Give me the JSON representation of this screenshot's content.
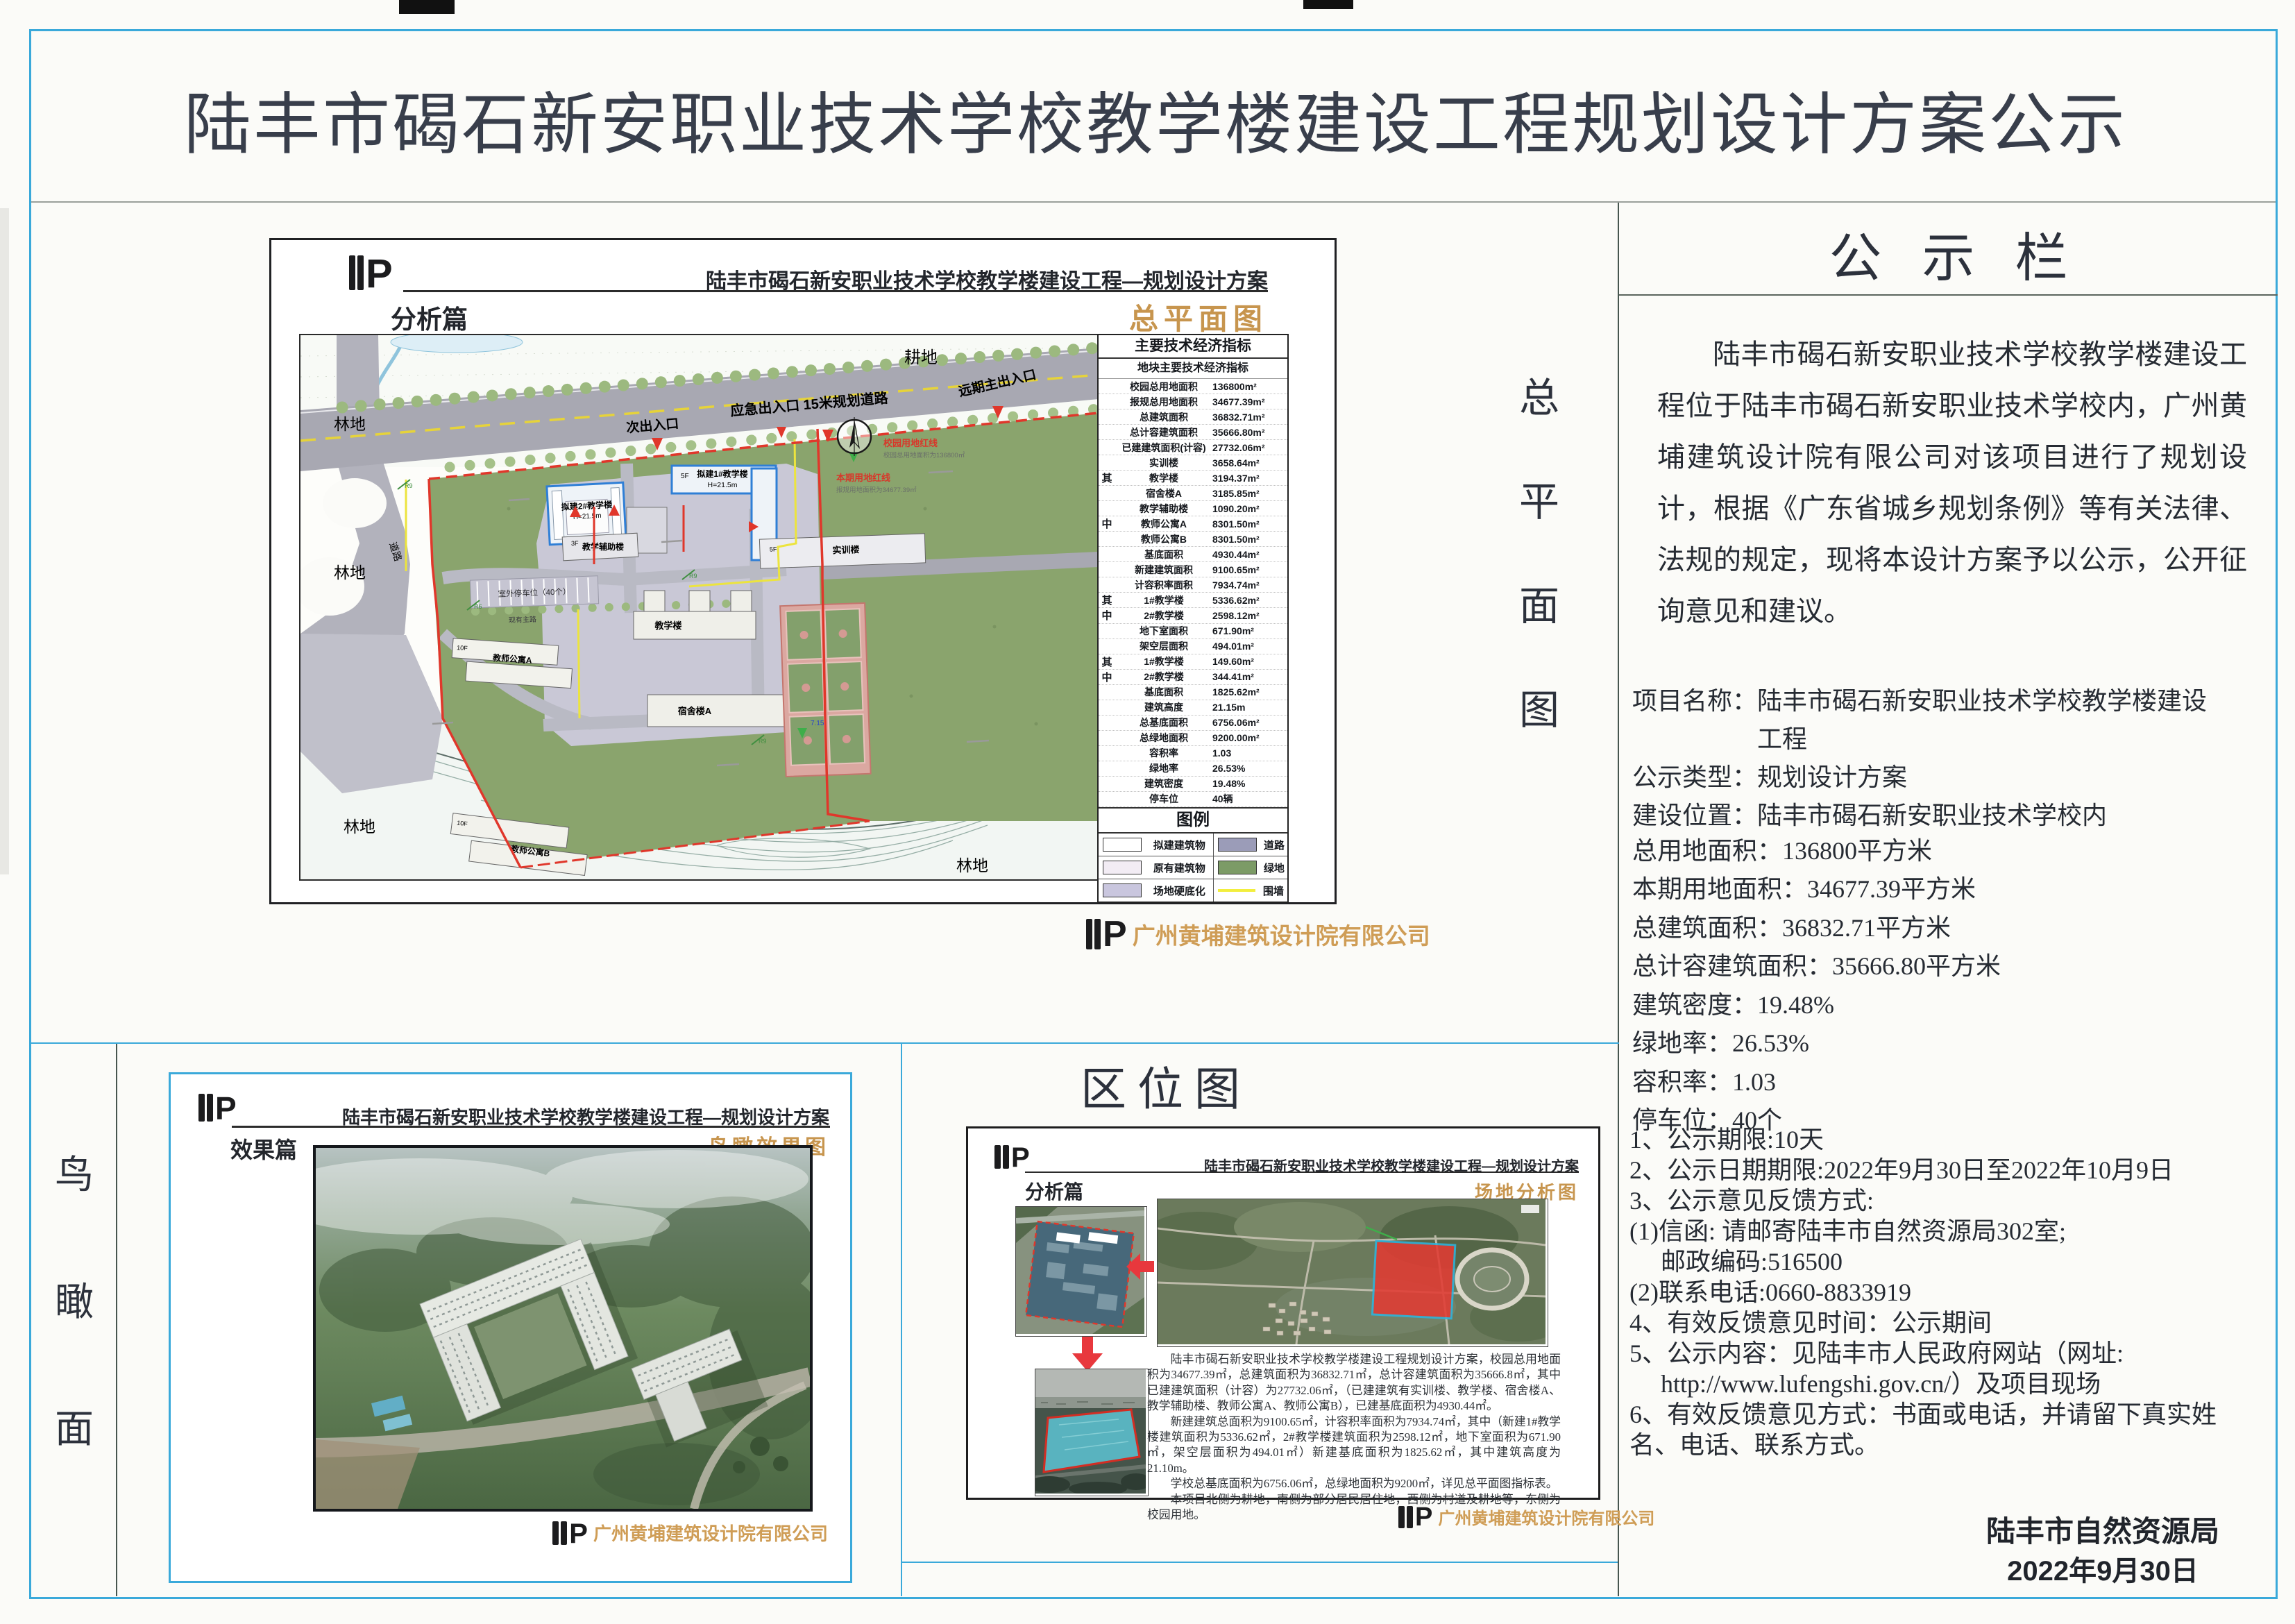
{
  "title": "陆丰市碣石新安职业技术学校教学楼建设工程规划设计方案公示",
  "common": {
    "project_header": "陆丰市碣石新安职业技术学校教学楼建设工程—规划设计方案",
    "company": "广州黄埔建筑设计院有限公司",
    "logo_letter": "P"
  },
  "vertical_labels": {
    "master_plan": [
      "总",
      "平",
      "面",
      "图"
    ],
    "aerial_view": [
      "鸟",
      "瞰",
      "面"
    ]
  },
  "site_plan": {
    "section": "分析篇",
    "sheet": "总平面图",
    "plan_labels": {
      "farmland": "耕地",
      "forest": "林地",
      "road_vertical": "道路",
      "planned_road": "应急出入口 15米规划道路",
      "secondary_entrance": "次出入口",
      "future_main_entrance": "远期主出入口",
      "new_building_1": "拟建1#教学楼",
      "new_building_2": "拟建2#教学楼",
      "building_height": "H=21.5m",
      "aux_building": "教学辅助楼",
      "training_building": "实训楼",
      "teaching_building": "教学楼",
      "dorm_a": "宿舍楼A",
      "teacher_apt_a": "教师公寓A",
      "teacher_apt_b": "教师公寓B",
      "parking": "室外停车位（40个）",
      "existing_road": "现有主路",
      "campus_red_line": "校园用地红线",
      "campus_red_line_sub": "校园总用地面积为136800㎡",
      "current_red_line": "本期用地红线",
      "current_red_line_sub": "报规用地面积为34677.39㎡",
      "level_mark": "7.15",
      "floors_3f": "3F",
      "floors_5f": "5F",
      "floors_10f": "10F",
      "r9": "R9",
      "r6": "R6"
    },
    "indicators": {
      "title": "主要技术经济指标",
      "subtitle": "地块主要技术经济指标",
      "rows": [
        [
          "",
          "校园总用地面积",
          "136800m²"
        ],
        [
          "",
          "报规总用地面积",
          "34677.39m²"
        ],
        [
          "",
          "总建筑面积",
          "36832.71m²"
        ],
        [
          "",
          "总计容建筑面积",
          "35666.80m²"
        ],
        [
          "",
          "已建建筑面积(计容)",
          "27732.06m²"
        ],
        [
          "",
          "实训楼",
          "3658.64m²"
        ],
        [
          "其",
          "教学楼",
          "3194.37m²"
        ],
        [
          "",
          "宿舍楼A",
          "3185.85m²"
        ],
        [
          "",
          "教学辅助楼",
          "1090.20m²"
        ],
        [
          "中",
          "教师公寓A",
          "8301.50m²"
        ],
        [
          "",
          "教师公寓B",
          "8301.50m²"
        ],
        [
          "",
          "基底面积",
          "4930.44m²"
        ],
        [
          "",
          "新建建筑面积",
          "9100.65m²"
        ],
        [
          "",
          "计容积率面积",
          "7934.74m²"
        ],
        [
          "其",
          "1#教学楼",
          "5336.62m²"
        ],
        [
          "中",
          "2#教学楼",
          "2598.12m²"
        ],
        [
          "",
          "地下室面积",
          "671.90m²"
        ],
        [
          "",
          "架空层面积",
          "494.01m²"
        ],
        [
          "其",
          "1#教学楼",
          "149.60m²"
        ],
        [
          "中",
          "2#教学楼",
          "344.41m²"
        ],
        [
          "",
          "基底面积",
          "1825.62m²"
        ],
        [
          "",
          "建筑高度",
          "21.15m"
        ],
        [
          "",
          "总基底面积",
          "6756.06m²"
        ],
        [
          "",
          "总绿地面积",
          "9200.00m²"
        ],
        [
          "",
          "容积率",
          "1.03"
        ],
        [
          "",
          "绿地率",
          "26.53%"
        ],
        [
          "",
          "建筑密度",
          "19.48%"
        ],
        [
          "",
          "停车位",
          "40辆"
        ]
      ],
      "legend": {
        "title": "图例",
        "row1": {
          "c1": "#ffffff",
          "l1": "拟建建筑物",
          "c2": "#9b9cb8",
          "l2": "道路"
        },
        "row2": {
          "c1": "#f2ecf4",
          "l1": "原有建筑物",
          "c2": "#7c9b66",
          "l2": "绿地"
        },
        "row3": {
          "c1": "#c9c6de",
          "l1": "场地硬底化",
          "c2": "#f2ee3e",
          "l2": "围墙"
        }
      }
    }
  },
  "aerial": {
    "section": "效果篇",
    "sheet": "鸟瞰效果图"
  },
  "location": {
    "title": "区位图",
    "section": "分析篇",
    "sheet": "场地分析图",
    "paragraphs": [
      "陆丰市碣石新安职业技术学校教学楼建设工程规划设计方案，校园总用地面积为34677.39㎡，总建筑面积为36832.71㎡，总计容建筑面积为35666.8㎡，其中已建建筑面积（计容）为27732.06㎡，（已建建筑有实训楼、教学楼、宿舍楼A、教学辅助楼、教师公寓A、教师公寓B），已建基底面积为4930.44㎡。",
      "新建建筑总面积为9100.65㎡，计容积率面积为7934.74㎡，其中（新建1#教学楼建筑面积为5336.62㎡，2#教学楼建筑面积为2598.12㎡，地下室面积为671.90㎡，架空层面积为494.01㎡）新建基底面积为1825.62㎡，其中建筑高度为21.10m。",
      "学校总基底面积为6756.06㎡，总绿地面积为9200㎡，详见总平面图指标表。",
      "本项目北侧为耕地，南侧为部分居民居住地，西侧为村道及耕地等，东侧为校园用地。"
    ]
  },
  "announcement": {
    "title": "公示栏",
    "intro": "陆丰市碣石新安职业技术学校教学楼建设工程位于陆丰市碣石新安职业技术学校内，广州黄埔建筑设计院有限公司对该项目进行了规划设计，根据《广东省城乡规划条例》等有关法律、法规的规定，现将本设计方案予以公示，公开征询意见和建议。",
    "fields": [
      "项目名称：陆丰市碣石新安职业技术学校教学楼建设",
      "　　　　　工程",
      "公示类型：规划设计方案",
      "建设位置：陆丰市碣石新安职业技术学校内"
    ],
    "metrics": [
      "总用地面积：136800平方米",
      "本期用地面积：34677.39平方米",
      "总建筑面积：36832.71平方米",
      "总计容建筑面积：35666.80平方米",
      "建筑密度：19.48%",
      "绿地率：26.53%",
      "容积率：1.03",
      "停车位：40个"
    ],
    "notes": [
      "1、公示期限:10天",
      "2、公示日期期限:2022年9月30日至2022年10月9日",
      "3、公示意见反馈方式:",
      "(1)信函: 请邮寄陆丰市自然资源局302室;",
      "　 邮政编码:516500",
      "(2)联系电话:0660-8833919",
      "4、有效反馈意见时间：公示期间",
      "5、公示内容：见陆丰市人民政府网站（网址:",
      "　 http://www.lufengshi.gov.cn/）及项目现场",
      "6、有效反馈意见方式：书面或电话，并请留下真实姓",
      "名、电话、联系方式。"
    ],
    "signature": [
      "陆丰市自然资源局",
      "2022年9月30日"
    ]
  },
  "colors": {
    "frame_cyan": "#3aa9da",
    "accent_orange": "#c7954e",
    "red_line": "#e0372b",
    "field_green": "#8aa46d",
    "road_gray": "#a8a8b2"
  }
}
